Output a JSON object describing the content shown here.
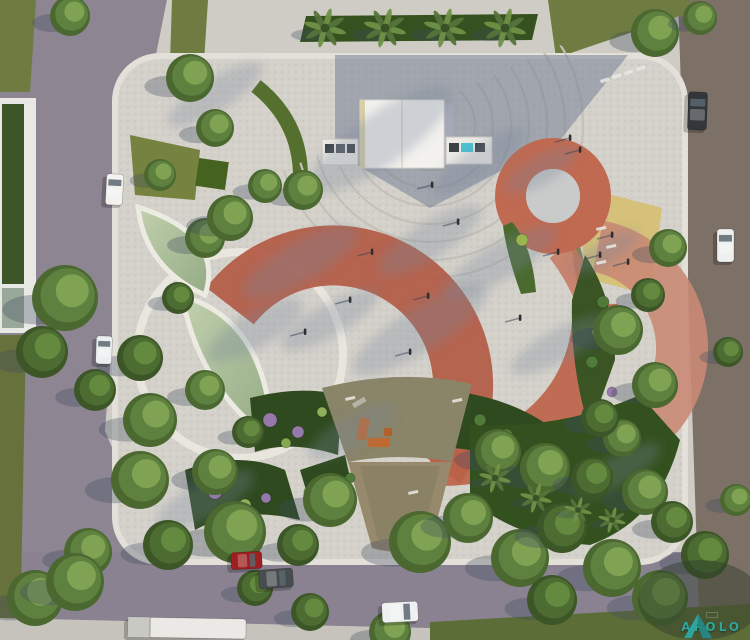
{
  "logo": {
    "text": "APOLO",
    "color": "#2ab5b5"
  },
  "palette": {
    "plaza_concrete": "#d4d1ca",
    "road_left": "#8d8591",
    "road_right": "#7c7067",
    "road_bottom": "#8a8290",
    "lawn": "#6f7c41",
    "planting_bed": "#2f4a1e",
    "water": "#b4c5a0",
    "pond_rim": "#e9e6de",
    "arc_red": "#b25a44",
    "arc_salmon": "#c98a74",
    "ring_red": "#c06a52",
    "yellow_court": "#d5c17a",
    "playground_surface": "#8a8468",
    "sand": "#97896c",
    "stage_roof": "#f2f1ed",
    "shadow_blue": "#6d7a90"
  },
  "scene": {
    "trees": [
      [
        190,
        78,
        24,
        1
      ],
      [
        70,
        16,
        20,
        1
      ],
      [
        205,
        238,
        20,
        1
      ],
      [
        178,
        298,
        16,
        2
      ],
      [
        150,
        420,
        27,
        1
      ],
      [
        65,
        298,
        33,
        1
      ],
      [
        42,
        352,
        26,
        2
      ],
      [
        95,
        390,
        21,
        2
      ],
      [
        230,
        218,
        23,
        1
      ],
      [
        303,
        190,
        20,
        1
      ],
      [
        265,
        186,
        17,
        1
      ],
      [
        215,
        128,
        19,
        1
      ],
      [
        140,
        358,
        23,
        2
      ],
      [
        205,
        390,
        20,
        1
      ],
      [
        248,
        432,
        16,
        2
      ],
      [
        140,
        480,
        29,
        1
      ],
      [
        215,
        472,
        23,
        1
      ],
      [
        235,
        532,
        31,
        1
      ],
      [
        168,
        545,
        25,
        2
      ],
      [
        88,
        552,
        24,
        1
      ],
      [
        35,
        598,
        28,
        1
      ],
      [
        255,
        588,
        18,
        2
      ],
      [
        330,
        500,
        27,
        1
      ],
      [
        298,
        545,
        21,
        2
      ],
      [
        420,
        542,
        31,
        1
      ],
      [
        468,
        518,
        25,
        1
      ],
      [
        520,
        558,
        29,
        1
      ],
      [
        562,
        528,
        25,
        2
      ],
      [
        612,
        568,
        29,
        1
      ],
      [
        660,
        598,
        28,
        1
      ],
      [
        705,
        555,
        24,
        2
      ],
      [
        498,
        452,
        23,
        1
      ],
      [
        545,
        468,
        25,
        1
      ],
      [
        592,
        478,
        21,
        2
      ],
      [
        622,
        438,
        19,
        1
      ],
      [
        645,
        492,
        23,
        1
      ],
      [
        672,
        522,
        21,
        2
      ],
      [
        618,
        330,
        25,
        1
      ],
      [
        655,
        385,
        23,
        1
      ],
      [
        600,
        418,
        19,
        2
      ],
      [
        648,
        295,
        17,
        2
      ],
      [
        668,
        248,
        19,
        1
      ],
      [
        655,
        33,
        24,
        1
      ],
      [
        75,
        582,
        29,
        1
      ],
      [
        390,
        632,
        21,
        1
      ],
      [
        310,
        612,
        19,
        2
      ],
      [
        552,
        600,
        25,
        2
      ],
      [
        700,
        18,
        17,
        1
      ],
      [
        728,
        352,
        15,
        2
      ],
      [
        736,
        500,
        16,
        1
      ],
      [
        160,
        175,
        16,
        1
      ]
    ],
    "palms": [
      [
        325,
        28,
        20
      ],
      [
        385,
        28,
        20
      ],
      [
        445,
        28,
        20
      ],
      [
        505,
        28,
        20
      ],
      [
        495,
        478,
        15
      ],
      [
        536,
        498,
        15
      ],
      [
        578,
        510,
        13
      ],
      [
        612,
        520,
        13
      ]
    ],
    "shadow_streaks": [
      [
        380,
        140,
        85,
        26,
        -35
      ],
      [
        300,
        262,
        65,
        20,
        -30
      ],
      [
        420,
        330,
        78,
        22,
        -32
      ],
      [
        255,
        330,
        55,
        18,
        -30
      ],
      [
        500,
        262,
        65,
        18,
        -30
      ],
      [
        560,
        345,
        55,
        16,
        -28
      ],
      [
        352,
        432,
        50,
        16,
        -30
      ],
      [
        480,
        162,
        55,
        16,
        -35
      ],
      [
        605,
        252,
        38,
        12,
        -30
      ],
      [
        205,
        500,
        55,
        18,
        -28
      ],
      [
        618,
        470,
        48,
        15,
        -30
      ],
      [
        430,
        240,
        60,
        18,
        -32
      ],
      [
        330,
        320,
        55,
        16,
        -30
      ],
      [
        540,
        170,
        40,
        14,
        -30
      ],
      [
        215,
        95,
        55,
        16,
        -32
      ]
    ],
    "people": [
      [
        372,
        252
      ],
      [
        428,
        296
      ],
      [
        458,
        222
      ],
      [
        520,
        318
      ],
      [
        570,
        138
      ],
      [
        580,
        150
      ],
      [
        558,
        252
      ],
      [
        305,
        332
      ],
      [
        410,
        352
      ],
      [
        612,
        235
      ],
      [
        600,
        255
      ],
      [
        628,
        262
      ],
      [
        432,
        185
      ],
      [
        350,
        300
      ]
    ],
    "cars": [
      {
        "name": "white-car-left-road-upper",
        "x": 106,
        "y": 174,
        "w": 17,
        "h": 31,
        "rot": 3,
        "color": "#f2f2ef",
        "horiz": false
      },
      {
        "name": "white-car-left-road-lower",
        "x": 96,
        "y": 336,
        "w": 16,
        "h": 28,
        "rot": 2,
        "color": "#eceff0",
        "horiz": false
      },
      {
        "name": "dark-car-right-road",
        "x": 688,
        "y": 92,
        "w": 19,
        "h": 38,
        "rot": 2,
        "color": "#33373c",
        "horiz": false
      },
      {
        "name": "white-car-right-road",
        "x": 717,
        "y": 229,
        "w": 17,
        "h": 33,
        "rot": 0,
        "color": "#eef0f0",
        "horiz": false
      },
      {
        "name": "red-car-bottom-road",
        "x": 231,
        "y": 552,
        "w": 31,
        "h": 17,
        "rot": -3,
        "color": "#9e1f1f",
        "horiz": true
      },
      {
        "name": "gray-car-bottom-road",
        "x": 259,
        "y": 569,
        "w": 34,
        "h": 19,
        "rot": -4,
        "color": "#474c4f",
        "horiz": true
      },
      {
        "name": "white-car-bottom-road",
        "x": 382,
        "y": 602,
        "w": 36,
        "h": 20,
        "rot": -3,
        "color": "#eff1f0",
        "horiz": true
      },
      {
        "name": "white-truck-bottom-left",
        "x": 128,
        "y": 618,
        "w": 118,
        "h": 20,
        "rot": 1,
        "color": "#eae9e5",
        "horiz": true,
        "truck": true
      }
    ],
    "shrubs": [
      [
        270,
        420,
        7,
        "#9679ab"
      ],
      [
        298,
        432,
        6,
        "#9679ab"
      ],
      [
        322,
        412,
        5,
        "#8fb05a"
      ],
      [
        286,
        443,
        5,
        "#87a650"
      ],
      [
        480,
        420,
        6,
        "#4f7a38"
      ],
      [
        506,
        436,
        7,
        "#55803b"
      ],
      [
        530,
        456,
        6,
        "#8fb05a"
      ],
      [
        215,
        492,
        7,
        "#9679ab"
      ],
      [
        245,
        505,
        6,
        "#8fb05a"
      ],
      [
        266,
        498,
        5,
        "#9679ab"
      ],
      [
        603,
        302,
        6,
        "#4f7a38"
      ],
      [
        597,
        332,
        5,
        "#8fb05a"
      ],
      [
        592,
        362,
        6,
        "#4f7a38"
      ],
      [
        612,
        392,
        5,
        "#9679ab"
      ],
      [
        522,
        240,
        6,
        "#9ab54e"
      ],
      [
        310,
        492,
        6,
        "#87a650"
      ],
      [
        350,
        478,
        5,
        "#4f7a38"
      ]
    ],
    "crosswalk_dashes": [
      [
        600,
        80
      ],
      [
        612,
        76
      ],
      [
        624,
        72
      ],
      [
        636,
        68
      ]
    ],
    "benches": [
      [
        596,
        228
      ],
      [
        606,
        246
      ],
      [
        596,
        262
      ],
      [
        408,
        492
      ],
      [
        345,
        398
      ],
      [
        452,
        400
      ]
    ]
  }
}
